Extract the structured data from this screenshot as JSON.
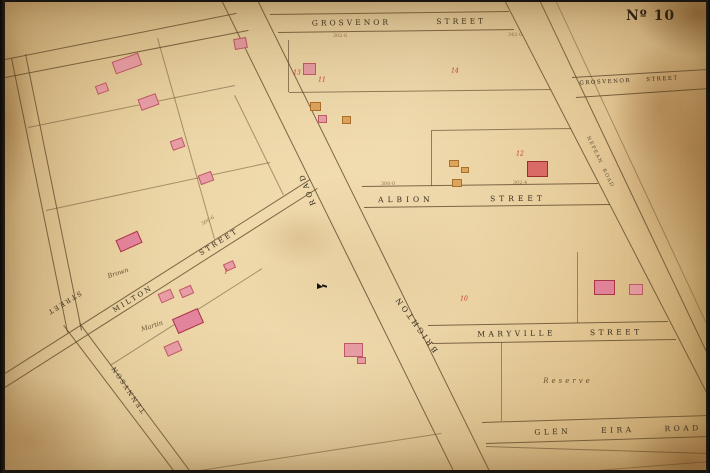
{
  "map": {
    "plate_number": "Nº 10",
    "colors": {
      "paper": "#e9d2a2",
      "line": "#5f4a2c",
      "label": "#332a1d",
      "lot_number_red": "#c13528",
      "building_pink": "#e89da6",
      "building_red": "#d96a66",
      "building_orange": "#dda45c"
    },
    "street_labels": [
      {
        "name": "grosvenor-street-top",
        "text": "GROSVENOR STREET",
        "x": 399,
        "y": 22,
        "rot": -0.7,
        "fs": 7.5,
        "ls": 3,
        "ws": 40
      },
      {
        "name": "grosvenor-street-right",
        "text": "GROSVENOR STREET",
        "x": 629,
        "y": 81,
        "rot": -3,
        "fs": 5.5,
        "ls": 1.5,
        "ws": 12
      },
      {
        "name": "albion-street",
        "text": "ALBION STREET",
        "x": 462,
        "y": 199,
        "rot": -0.5,
        "fs": 7.5,
        "ls": 4,
        "ws": 50
      },
      {
        "name": "maryville-street",
        "text": "MARYVILLE STREET",
        "x": 560,
        "y": 333,
        "rot": -0.8,
        "fs": 7.5,
        "ls": 3.5,
        "ws": 28
      },
      {
        "name": "glen-eira-road",
        "text": "GLEN EIRA ROAD",
        "x": 618,
        "y": 430,
        "rot": -1.5,
        "fs": 7.5,
        "ls": 3.5,
        "ws": 24
      },
      {
        "name": "brighton-road-word-brighton",
        "text": "BRIGHTON",
        "x": 416,
        "y": 324,
        "rot": -126,
        "fs": 7.5,
        "ls": 3,
        "ws": 4
      },
      {
        "name": "brighton-road-word-road",
        "text": "ROAD",
        "x": 307,
        "y": 189,
        "rot": -112,
        "fs": 7.5,
        "ls": 3,
        "ws": 4
      },
      {
        "name": "milton-street-word-milton",
        "text": "MILTON",
        "x": 133,
        "y": 299,
        "rot": -31,
        "fs": 7,
        "ls": 2.5,
        "ws": 4
      },
      {
        "name": "milton-street-word-street",
        "text": "STREET",
        "x": 219,
        "y": 242,
        "rot": -32,
        "fs": 7,
        "ls": 2.5,
        "ws": 4
      },
      {
        "name": "street-left",
        "text": "STREET",
        "x": 64,
        "y": 303,
        "rot": 148,
        "fs": 6.5,
        "ls": 2,
        "ws": 4
      },
      {
        "name": "tennyson-street",
        "text": "TENNYSON",
        "x": 128,
        "y": 389,
        "rot": -124,
        "fs": 6.5,
        "ls": 2,
        "ws": 4
      },
      {
        "name": "nepean-road",
        "text": "NEPEAN ROAD",
        "x": 600,
        "y": 162,
        "rot": 64,
        "fs": 5,
        "ls": 1.2,
        "ws": 3,
        "o": 0.75
      }
    ],
    "owner_labels": [
      {
        "name": "owner-brown",
        "text": "Brown",
        "x": 118,
        "y": 273,
        "rot": -18,
        "fs": 6.5
      },
      {
        "name": "owner-martin",
        "text": "Martin",
        "x": 152,
        "y": 326,
        "rot": -18,
        "fs": 6.5
      },
      {
        "name": "reserve-label",
        "text": "Reserve",
        "x": 568,
        "y": 381,
        "rot": 0,
        "fs": 7,
        "ls": 3
      }
    ],
    "lot_numbers": [
      {
        "text": "13",
        "x": 297,
        "y": 73
      },
      {
        "text": "11",
        "x": 322,
        "y": 80
      },
      {
        "text": "14",
        "x": 455,
        "y": 71
      },
      {
        "text": "12",
        "x": 520,
        "y": 154
      },
      {
        "text": "10",
        "x": 464,
        "y": 299
      },
      {
        "text": "1",
        "x": 226,
        "y": 272
      }
    ],
    "dimension_labels": [
      {
        "text": "302·6",
        "x": 340,
        "y": 36,
        "rot": 0
      },
      {
        "text": "342·0",
        "x": 515,
        "y": 35,
        "rot": 0
      },
      {
        "text": "300·0",
        "x": 388,
        "y": 184,
        "rot": 0
      },
      {
        "text": "302·4",
        "x": 520,
        "y": 183,
        "rot": 0
      },
      {
        "text": "300·6",
        "x": 208,
        "y": 221,
        "rot": -32
      }
    ],
    "lines": [
      {
        "x1": 0,
        "y1": 60,
        "x2": 236,
        "y2": 13
      },
      {
        "x1": 0,
        "y1": 78,
        "x2": 248,
        "y2": 30
      },
      {
        "x1": 270,
        "y1": 14,
        "x2": 509,
        "y2": 11
      },
      {
        "x1": 278,
        "y1": 32,
        "x2": 514,
        "y2": 29
      },
      {
        "x1": 572,
        "y1": 77,
        "x2": 708,
        "y2": 69
      },
      {
        "x1": 576,
        "y1": 97,
        "x2": 710,
        "y2": 88
      },
      {
        "x1": 222,
        "y1": 0,
        "x2": 455,
        "y2": 473,
        "t": 1.2
      },
      {
        "x1": 258,
        "y1": 0,
        "x2": 491,
        "y2": 473,
        "t": 1.2
      },
      {
        "x1": 505,
        "y1": 0,
        "x2": 710,
        "y2": 398,
        "t": 1.2
      },
      {
        "x1": 540,
        "y1": 0,
        "x2": 710,
        "y2": 358,
        "t": 1.2
      },
      {
        "x1": 556,
        "y1": 0,
        "x2": 710,
        "y2": 330,
        "o": 0.45
      },
      {
        "x1": 362,
        "y1": 186,
        "x2": 598,
        "y2": 183
      },
      {
        "x1": 364,
        "y1": 207,
        "x2": 610,
        "y2": 204
      },
      {
        "x1": 428,
        "y1": 325,
        "x2": 668,
        "y2": 321
      },
      {
        "x1": 432,
        "y1": 343,
        "x2": 676,
        "y2": 339
      },
      {
        "x1": 482,
        "y1": 422,
        "x2": 710,
        "y2": 415
      },
      {
        "x1": 486,
        "y1": 443,
        "x2": 710,
        "y2": 436
      },
      {
        "x1": 0,
        "y1": 376,
        "x2": 310,
        "y2": 179
      },
      {
        "x1": 0,
        "y1": 390,
        "x2": 317,
        "y2": 188
      },
      {
        "x1": 64,
        "y1": 325,
        "x2": 176,
        "y2": 473
      },
      {
        "x1": 80,
        "y1": 323,
        "x2": 192,
        "y2": 473
      },
      {
        "x1": 12,
        "y1": 58,
        "x2": 68,
        "y2": 332
      },
      {
        "x1": 26,
        "y1": 54,
        "x2": 82,
        "y2": 330
      },
      {
        "x1": 28,
        "y1": 127,
        "x2": 235,
        "y2": 85,
        "o": 0.5
      },
      {
        "x1": 46,
        "y1": 210,
        "x2": 270,
        "y2": 162,
        "o": 0.5
      },
      {
        "x1": 158,
        "y1": 38,
        "x2": 215,
        "y2": 239,
        "o": 0.5
      },
      {
        "x1": 110,
        "y1": 365,
        "x2": 262,
        "y2": 268,
        "o": 0.5
      },
      {
        "x1": 235,
        "y1": 95,
        "x2": 284,
        "y2": 195,
        "o": 0.5
      },
      {
        "x1": 200,
        "y1": 470,
        "x2": 441,
        "y2": 433,
        "o": 0.5
      },
      {
        "x1": 289,
        "y1": 40,
        "x2": 289,
        "y2": 92,
        "o": 0.65
      },
      {
        "x1": 289,
        "y1": 92,
        "x2": 551,
        "y2": 89,
        "o": 0.65
      },
      {
        "x1": 432,
        "y1": 130,
        "x2": 571,
        "y2": 128,
        "o": 0.65
      },
      {
        "x1": 432,
        "y1": 130,
        "x2": 432,
        "y2": 186,
        "o": 0.65
      },
      {
        "x1": 578,
        "y1": 252,
        "x2": 578,
        "y2": 323,
        "o": 0.55
      },
      {
        "x1": 502,
        "y1": 342,
        "x2": 502,
        "y2": 421,
        "o": 0.55
      },
      {
        "x1": 486,
        "y1": 446,
        "x2": 708,
        "y2": 453,
        "o": 0.6
      },
      {
        "x1": 560,
        "y1": 473,
        "x2": 710,
        "y2": 461,
        "o": 0.5
      }
    ],
    "buildings": [
      {
        "x": 113,
        "y": 57,
        "w": 28,
        "h": 13,
        "c": "pink",
        "r": -20
      },
      {
        "x": 96,
        "y": 84,
        "w": 12,
        "h": 9,
        "c": "pink",
        "r": -20
      },
      {
        "x": 139,
        "y": 96,
        "w": 19,
        "h": 12,
        "c": "pink",
        "r": -20
      },
      {
        "x": 171,
        "y": 139,
        "w": 13,
        "h": 10,
        "c": "pink",
        "r": -20
      },
      {
        "x": 199,
        "y": 173,
        "w": 14,
        "h": 10,
        "c": "pink",
        "r": -20
      },
      {
        "x": 117,
        "y": 235,
        "w": 24,
        "h": 13,
        "c": "pinkred",
        "r": -24
      },
      {
        "x": 224,
        "y": 262,
        "w": 11,
        "h": 8,
        "c": "pink",
        "r": -24
      },
      {
        "x": 159,
        "y": 291,
        "w": 14,
        "h": 10,
        "c": "pink",
        "r": -24
      },
      {
        "x": 180,
        "y": 287,
        "w": 13,
        "h": 9,
        "c": "pink",
        "r": -24
      },
      {
        "x": 174,
        "y": 313,
        "w": 28,
        "h": 16,
        "c": "pinkred",
        "r": -24
      },
      {
        "x": 165,
        "y": 343,
        "w": 16,
        "h": 11,
        "c": "pink",
        "r": -24
      },
      {
        "x": 234,
        "y": 38,
        "w": 13,
        "h": 11,
        "c": "pink",
        "r": -10
      },
      {
        "x": 303,
        "y": 63,
        "w": 13,
        "h": 12,
        "c": "pink",
        "r": 0
      },
      {
        "x": 310,
        "y": 102,
        "w": 11,
        "h": 9,
        "c": "orange",
        "r": 0
      },
      {
        "x": 318,
        "y": 115,
        "w": 9,
        "h": 8,
        "c": "pink",
        "r": 0
      },
      {
        "x": 342,
        "y": 116,
        "w": 9,
        "h": 8,
        "c": "orange",
        "r": 0
      },
      {
        "x": 449,
        "y": 160,
        "w": 10,
        "h": 7,
        "c": "orange",
        "r": 0
      },
      {
        "x": 461,
        "y": 167,
        "w": 8,
        "h": 6,
        "c": "orange",
        "r": 0
      },
      {
        "x": 452,
        "y": 179,
        "w": 10,
        "h": 8,
        "c": "orange",
        "r": 0
      },
      {
        "x": 527,
        "y": 161,
        "w": 21,
        "h": 16,
        "c": "red",
        "r": 0
      },
      {
        "x": 344,
        "y": 343,
        "w": 19,
        "h": 14,
        "c": "pink",
        "r": 0
      },
      {
        "x": 357,
        "y": 357,
        "w": 9,
        "h": 7,
        "c": "pink",
        "r": 0
      },
      {
        "x": 594,
        "y": 280,
        "w": 21,
        "h": 15,
        "c": "pinkred",
        "r": 0
      },
      {
        "x": 629,
        "y": 284,
        "w": 14,
        "h": 11,
        "c": "pink",
        "r": 0
      }
    ],
    "survey_mark": {
      "x": 317,
      "y": 283
    }
  }
}
